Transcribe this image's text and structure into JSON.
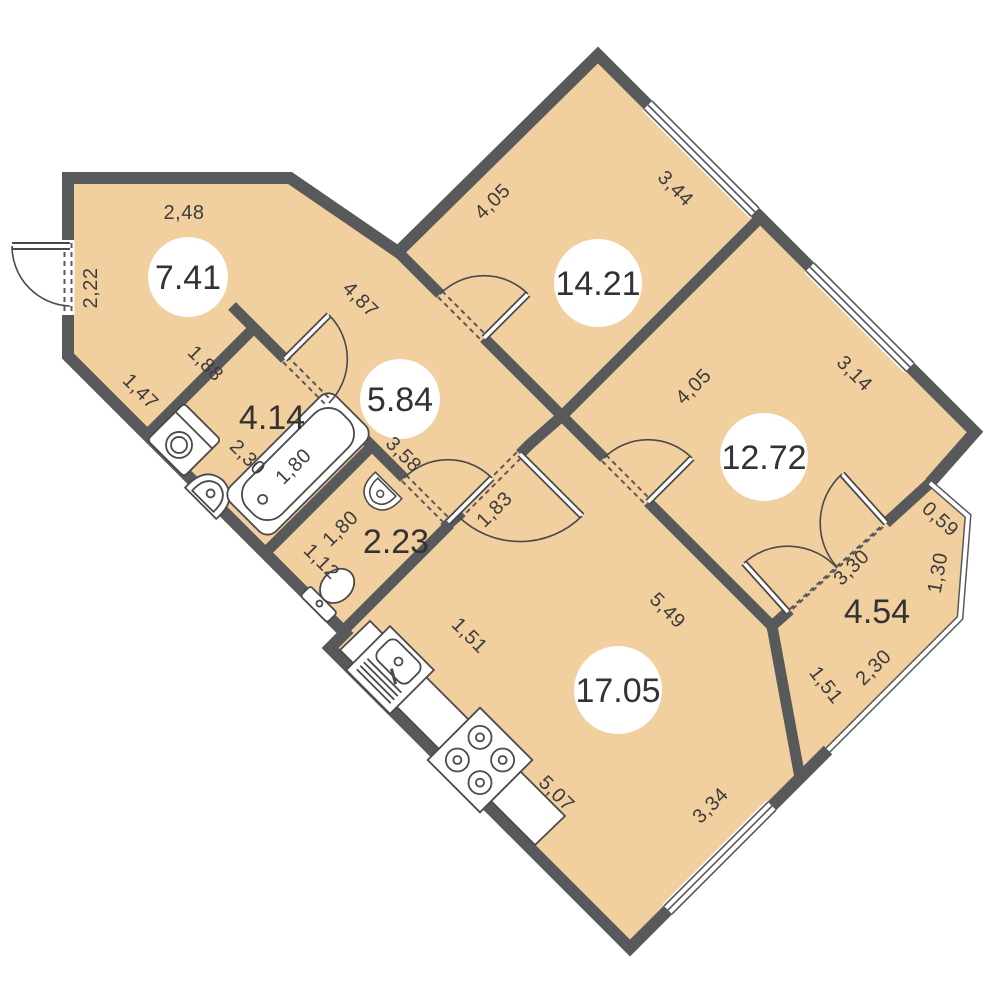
{
  "plan": {
    "title": "apartment-floor-plan",
    "colors": {
      "wall": "#58595b",
      "floor": "#f2cf9e",
      "label": "#3c3c3c",
      "fixture_stroke": "#4a4a4a",
      "background": "#ffffff"
    },
    "rooms": [
      {
        "area": "7.41",
        "circle": true
      },
      {
        "area": "14.21",
        "circle": true
      },
      {
        "area": "12.72",
        "circle": true
      },
      {
        "area": "5.84",
        "circle": true
      },
      {
        "area": "4.14",
        "circle": false
      },
      {
        "area": "2.23",
        "circle": false
      },
      {
        "area": "17.05",
        "circle": true
      },
      {
        "area": "4.54",
        "circle": false
      }
    ],
    "dims": [
      {
        "value": "2,48"
      },
      {
        "value": "2,22"
      },
      {
        "value": "1,47"
      },
      {
        "value": "1,88"
      },
      {
        "value": "4,87"
      },
      {
        "value": "4,05"
      },
      {
        "value": "3,44"
      },
      {
        "value": "4,05"
      },
      {
        "value": "3,14"
      },
      {
        "value": "3,58"
      },
      {
        "value": "2,30"
      },
      {
        "value": "1,80"
      },
      {
        "value": "1,80"
      },
      {
        "value": "1,12"
      },
      {
        "value": "1,83"
      },
      {
        "value": "5,49"
      },
      {
        "value": "3,30"
      },
      {
        "value": "0,59"
      },
      {
        "value": "1,30"
      },
      {
        "value": "2,30"
      },
      {
        "value": "1,51"
      },
      {
        "value": "1,51"
      },
      {
        "value": "5,07"
      },
      {
        "value": "3,34"
      }
    ]
  }
}
